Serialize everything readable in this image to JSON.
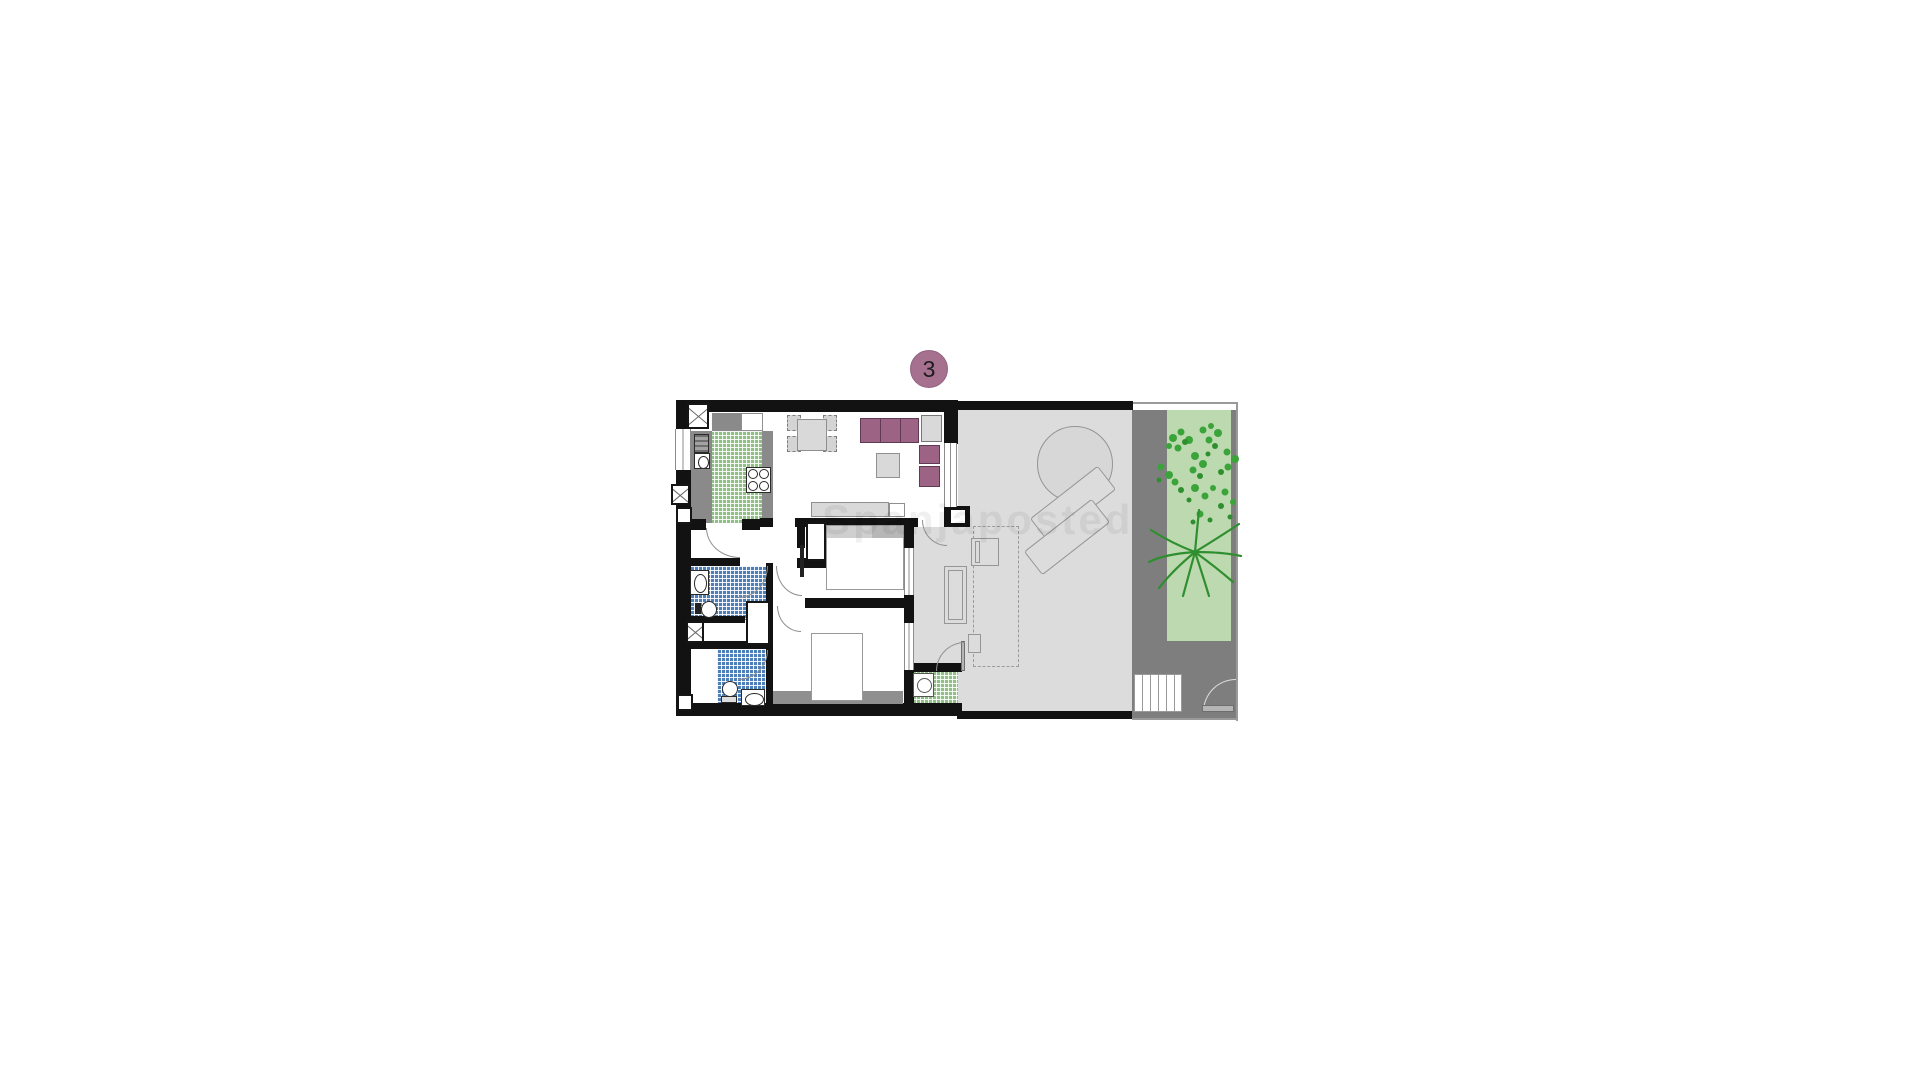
{
  "badge": {
    "label": "3"
  },
  "watermark": {
    "text": "Spanjaposted"
  },
  "colors": {
    "wall_black": "#121212",
    "counter_gray": "#8a8a8a",
    "tile_green": "#90c083",
    "tile_blue": "#4f7fb8",
    "terrace_gray": "#dcdcdd",
    "path_gray": "#7e7e7e",
    "garden_green": "#bdd9b0",
    "plant_green": "#3aa43a",
    "plant_green_dark": "#2f8f2f",
    "furniture_plum": "#9c6384",
    "furniture_plum_border": "#5f3a52",
    "badge_plum": "#a5718f",
    "light_furniture_gray": "#d9d9d9",
    "outline_gray": "#9a9a9a"
  }
}
